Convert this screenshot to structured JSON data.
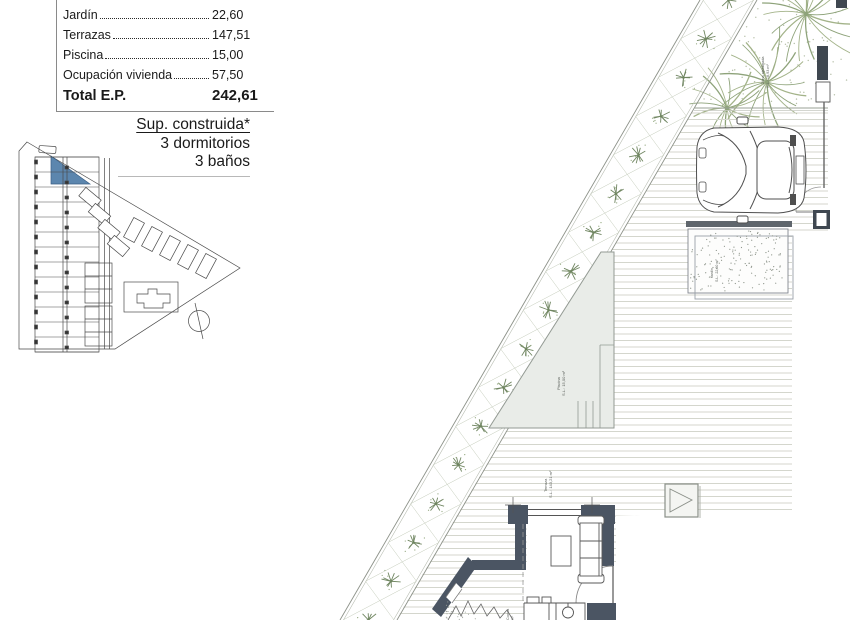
{
  "area_table": {
    "rows": [
      {
        "label": "Jardín",
        "value": "22,60"
      },
      {
        "label": "Terrazas",
        "value": "147,51"
      },
      {
        "label": "Piscina",
        "value": "15,00"
      },
      {
        "label": "Ocupación vivienda",
        "value": "57,50"
      }
    ],
    "total_label": "Total E.P.",
    "total_value": "242,61"
  },
  "summary": {
    "line1": "Sup. construida*",
    "line2": "3 dormitorios",
    "line3": "3 baños"
  },
  "plan_labels": {
    "pool_1": "Piscina",
    "pool_2": "S.L.: 15,00 m²",
    "terrace_1": "Terraza",
    "terrace_2": "S.L.: 143,21 m²",
    "garden_top_1": "Zona ajardinada",
    "garden_top_2": "S.L.: 18,93 m²",
    "gravel_1": "Jardín",
    "gravel_2": "S.L.: 22,60 m²",
    "kitchen_1": "Cocina",
    "kitchen_2": "m²"
  },
  "colors": {
    "highlight_unit": "#5c86ae",
    "wall": "#4b5563",
    "pool_fill": "#e9ece8",
    "plant_green": "#6f8560"
  }
}
